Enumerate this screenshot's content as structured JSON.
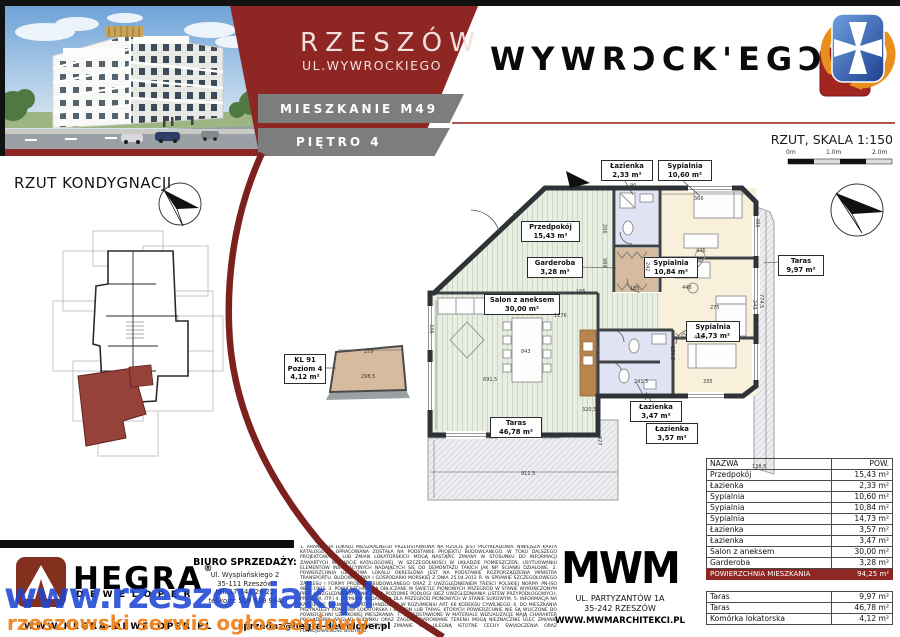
{
  "header": {
    "city": "RZESZÓW",
    "street": "UL.WYWROCKIEGO",
    "unit": "MIESZKANIE M49",
    "floor": "PIĘTRO 4",
    "brand_logo": "WYWRƆCK'EGƆ",
    "plan_caption": "RZUT, SKALA 1:150",
    "scale_labels": [
      {
        "t": "0m",
        "x": 786
      },
      {
        "t": "1.0m",
        "x": 826
      },
      {
        "t": "2.0m",
        "x": 872
      }
    ]
  },
  "left_panel": {
    "title": "RZUT KONDYGNACJI"
  },
  "floor_plan": {
    "room_labels": [
      {
        "name": "Łazienka",
        "area": "2,33 m²",
        "x": 601,
        "y": 160,
        "w": 48
      },
      {
        "name": "Sypialnia",
        "area": "10,60 m²",
        "x": 658,
        "y": 160,
        "w": 50
      },
      {
        "name": "Przedpokój",
        "area": "15,43 m²",
        "x": 521,
        "y": 221,
        "w": 55
      },
      {
        "name": "Garderoba",
        "area": "3,28 m²",
        "x": 527,
        "y": 257,
        "w": 52
      },
      {
        "name": "Sypialnia",
        "area": "10,84 m²",
        "x": 644,
        "y": 257,
        "w": 50
      },
      {
        "name": "Salon z aneksem",
        "area": "30,00 m²",
        "x": 484,
        "y": 294,
        "w": 72
      },
      {
        "name": "Sypialnia",
        "area": "14,73 m²",
        "x": 686,
        "y": 321,
        "w": 50
      },
      {
        "name": "Łazienka",
        "area": "3,47 m²",
        "x": 630,
        "y": 401,
        "w": 48
      },
      {
        "name": "Łazienka",
        "area": "3,57 m²",
        "x": 646,
        "y": 423,
        "w": 48
      },
      {
        "name": "Taras",
        "area": "46,78 m²",
        "x": 490,
        "y": 417,
        "w": 48
      },
      {
        "name": "Taras",
        "area": "9,97 m²",
        "x": 778,
        "y": 255,
        "w": 42
      }
    ],
    "storage_label": {
      "lines": [
        "KL 91",
        "Poziom 4",
        "4,12 m²"
      ],
      "x": 284,
      "y": 354,
      "w": 38
    },
    "dimensions": [
      {
        "t": "165",
        "x": 512,
        "y": 213,
        "r": -20
      },
      {
        "t": "90",
        "x": 630,
        "y": 183,
        "r": 0
      },
      {
        "t": "366",
        "x": 694,
        "y": 196,
        "r": 0
      },
      {
        "t": "380",
        "x": 760,
        "y": 218,
        "r": 90
      },
      {
        "t": "446",
        "x": 696,
        "y": 248,
        "r": 0
      },
      {
        "t": "206",
        "x": 607,
        "y": 224,
        "r": 90
      },
      {
        "t": "989",
        "x": 607,
        "y": 258,
        "r": 90
      },
      {
        "t": "242",
        "x": 650,
        "y": 262,
        "r": 90
      },
      {
        "t": "448",
        "x": 682,
        "y": 285,
        "r": 0
      },
      {
        "t": "135",
        "x": 630,
        "y": 286,
        "r": 0
      },
      {
        "t": "165",
        "x": 576,
        "y": 289,
        "r": 0
      },
      {
        "t": "1176",
        "x": 554,
        "y": 313,
        "r": 0
      },
      {
        "t": "336",
        "x": 434,
        "y": 324,
        "r": 90
      },
      {
        "t": "275",
        "x": 710,
        "y": 305,
        "r": 0
      },
      {
        "t": "243",
        "x": 757,
        "y": 300,
        "r": 90
      },
      {
        "t": "843",
        "x": 521,
        "y": 349,
        "r": 0
      },
      {
        "t": "159,5",
        "x": 675,
        "y": 346,
        "r": 90
      },
      {
        "t": "446",
        "x": 694,
        "y": 335,
        "r": 0
      },
      {
        "t": "335",
        "x": 703,
        "y": 379,
        "r": 0
      },
      {
        "t": "241,5",
        "x": 634,
        "y": 379,
        "r": 0
      },
      {
        "t": "691,5",
        "x": 483,
        "y": 377,
        "r": 0
      },
      {
        "t": "320,5",
        "x": 582,
        "y": 407,
        "r": 0
      },
      {
        "t": "561",
        "x": 432,
        "y": 422,
        "r": 90
      },
      {
        "t": "427",
        "x": 602,
        "y": 436,
        "r": 90
      },
      {
        "t": "912,5",
        "x": 521,
        "y": 471,
        "r": 0
      },
      {
        "t": "138,5",
        "x": 752,
        "y": 464,
        "r": 0
      },
      {
        "t": "774,5",
        "x": 764,
        "y": 294,
        "r": 90
      },
      {
        "t": "259",
        "x": 364,
        "y": 349,
        "r": 0
      },
      {
        "t": "298,5",
        "x": 361,
        "y": 374,
        "r": 0
      }
    ]
  },
  "area_table": {
    "col_name": "NAZWA",
    "col_area": "POW.",
    "rows": [
      {
        "name": "Przedpokój",
        "area": "15,43 m²"
      },
      {
        "name": "Łazienka",
        "area": "2,33 m²"
      },
      {
        "name": "Sypialnia",
        "area": "10,60 m²"
      },
      {
        "name": "Sypialnia",
        "area": "10,84 m²"
      },
      {
        "name": "Sypialnia",
        "area": "14,73 m²"
      },
      {
        "name": "Łazienka",
        "area": "3,57 m²"
      },
      {
        "name": "Łazienka",
        "area": "3,47 m²"
      },
      {
        "name": "Salon z aneksem",
        "area": "30,00 m²"
      },
      {
        "name": "Garderoba",
        "area": "3,28 m²"
      }
    ],
    "total_name": "POWIERZCHNIA MIESZKANIA",
    "total_area": "94,25 m²",
    "extra_rows": [
      {
        "name": "Taras",
        "area": "9,97 m²"
      },
      {
        "name": "Taras",
        "area": "46,78 m²"
      },
      {
        "name": "Komórka lokatorska",
        "area": "4,12 m²"
      }
    ]
  },
  "footer": {
    "developer": {
      "brand": "HEGRA",
      "reg": "®",
      "sub": "DEWELOPER",
      "website": "WWW.HEGRA-DEWELOPER.PL",
      "email": "sprzedaz@hegra-deweloper.pl"
    },
    "sales_office": {
      "title": "BIURO SPRZEDAŻY:",
      "lines": [
        "Ul. Wyspiańskiego 2",
        "35-111 Rzeszów",
        "tel. 17 748 26 22",
        "tel.kom: 509 539 984"
      ]
    },
    "architect": {
      "logo": "MWM",
      "address1": "UL. PARTYZANTÓW 1A",
      "address2": "35-242 RZESZÓW",
      "website": "WWW.MWMARCHITEKCI.PL"
    },
    "disclaimer": "1. ARANŻACJA LOKALU MIESZKALNEGO PRZEDSTAWIONA NA RZUCIE JEST PRZYKŁADOWA. NINIEJSZA KARTA KATALOGOWA OPRACOWANA ZOSTAŁA NA PODSTAWIE PROJEKTU BUDOWLANEGO. W TOKU DALSZEGO PROJEKTOWANIA LUB ZMIAN LOKATORSKICH MOGĄ NASTĄPIĆ ZMIANY W STOSUNKU DO INFORMACJI ZAWARTYCH W KARCIE KATALOGOWEJ, W SZCZEGÓLNOŚCI W UKŁADZIE POMIESZCZEŃ, USYTUOWANIU ELEMENTÓW INSTALACYJNYCH NADAJĄCYCH SIĘ DO DEMONTAŻU TAKICH JAK NP. ŚCIANKI DZIAŁOWE. 2. POWIERZCHNIA UŻYTKOWA LOKALU OKREŚLONA JEST NA PODSTAWIE ROZPORZĄDZENIA MINISTRA TRANSPORTU, BUDOWNICTWA I GOSPODARKI MORSKIEJ Z DNIA 25.04.2012 R. W SPRAWIE SZCZEGÓŁOWEGO ZAKRESU I FORMY PROJEKTU BUDOWLANEGO ORAZ Z UWZGLĘDNIENIEM TREŚCI POLSKIEJ NORMY PN-ISO 9836:1997. 3. POWIERZCHNIE SĄ OBLICZANE W ŚWIETLE PIONOWYCH PRZEGRÓD W STANIE WYKOŃCZONYM PRZY UWZGLĘDNIENIU TYNKÓW NA POZIOMIE PODŁOGI (BEZ UWZGLĘDNIANIA LISTEW PRZYPODŁOGOWYCH, PROGÓW, ITP.) 4. WYMIARY PODANE SĄ DLA PRZEGRÓD PIONOWYCH W STANIE SUROWYM. 5. INFORMACJA NA KARCIE NIE STANOWI OFERTY HANDLOWEJ W ROZUMIENIU ART. 66 KODEKSU CYWILNEGO. 6. DO MIESZKANIA PRZYNALEŻY KOMÓRKA LOKATORSKA I BALKON LUB TARAS, KTÓRYCH POWIERZCHNIE NIE SĄ WLICZONE DO POWIERZCHNI UŻYTKOWEJ MIESZKANIA. 7. PRZEDSTAWIONE W MATERIALE WIZUALIZACJE MAJĄ CHARAKTER POGLĄDOWY. WYGLĄD BUDYNKU ORAZ ZAGOSPODAROWANIE TERENU MOGĄ NIEZNACZNIE ULEC ZMIANIE PODCZAS REALIZACJI INWESTYCJI. ZMIANIE NIE ULEGNĄ ISTOTNE CECHY ŚWIADCZENIA ORAZ FUNKCJONALNOŚĆ BUDYNKU."
  },
  "watermark": {
    "line1": "www.rzeszowiak.pl",
    "line2": "rzeszowski serwis ogłoszeniowy"
  },
  "colors": {
    "accent_red": "#8E2723",
    "band_gray": "#7D7D7D",
    "watermark_blue": "#1E46D2",
    "watermark_orange": "#F0831E"
  }
}
